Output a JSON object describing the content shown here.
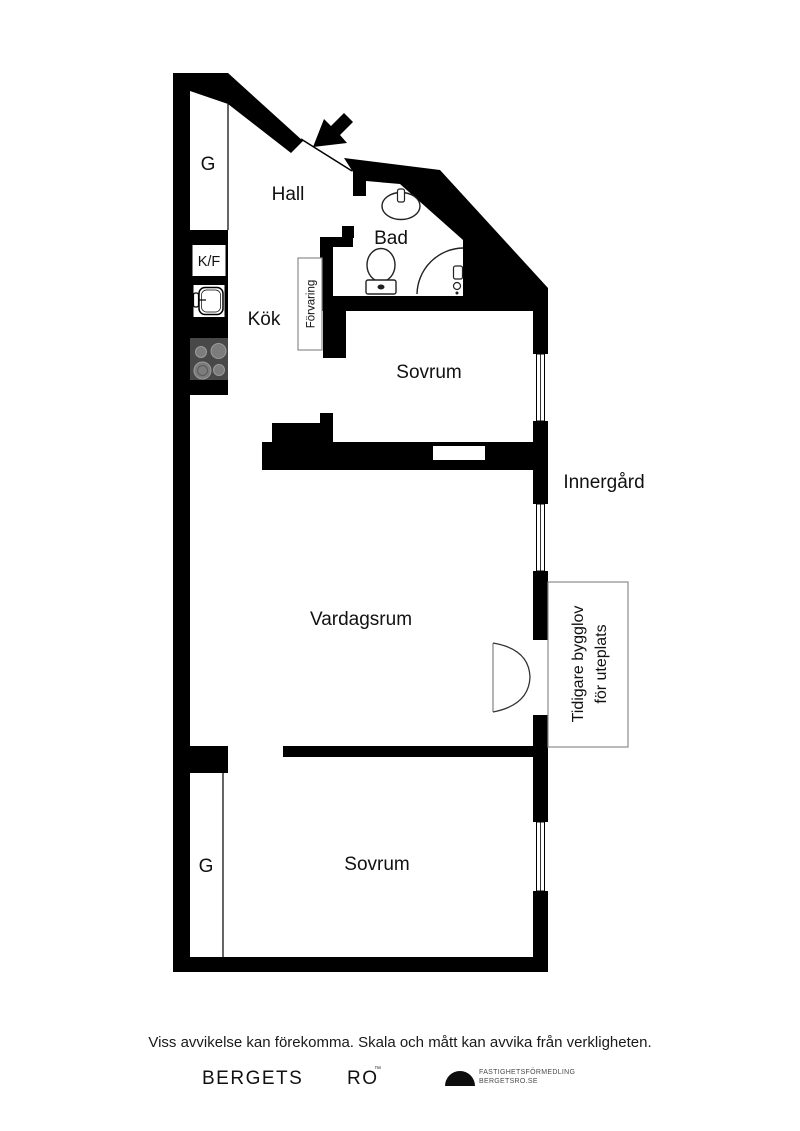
{
  "plan": {
    "labels": {
      "closet_top": "G",
      "closet_bottom": "G",
      "hall": "Hall",
      "bad": "Bad",
      "kf": "K/F",
      "kok": "Kök",
      "forvaring": "Förvaring",
      "sovrum_top": "Sovrum",
      "sovrum_bottom": "Sovrum",
      "vardagsrum": "Vardagsrum",
      "innergard": "Innergård",
      "uteplats_note_line1": "Tidigare bygglov",
      "uteplats_note_line2": "för uteplats"
    },
    "colors": {
      "wall": "#000000",
      "stove_body": "#484848",
      "burner_fill": "#7c7c7c",
      "burner_stroke": "#9b9b9b",
      "fixture_stroke": "#222222",
      "annotation_box_border": "#8c8c8c"
    }
  },
  "footer": {
    "disclaimer": "Viss avvikelse kan förekomma. Skala och mått kan avvika från verkligheten.",
    "brand_left": "BERGETS",
    "brand_right": "RO",
    "trademark": "™",
    "agency_line1": "FASTIGHETSFÖRMEDLING",
    "agency_line2": "BERGETSRO.SE"
  }
}
